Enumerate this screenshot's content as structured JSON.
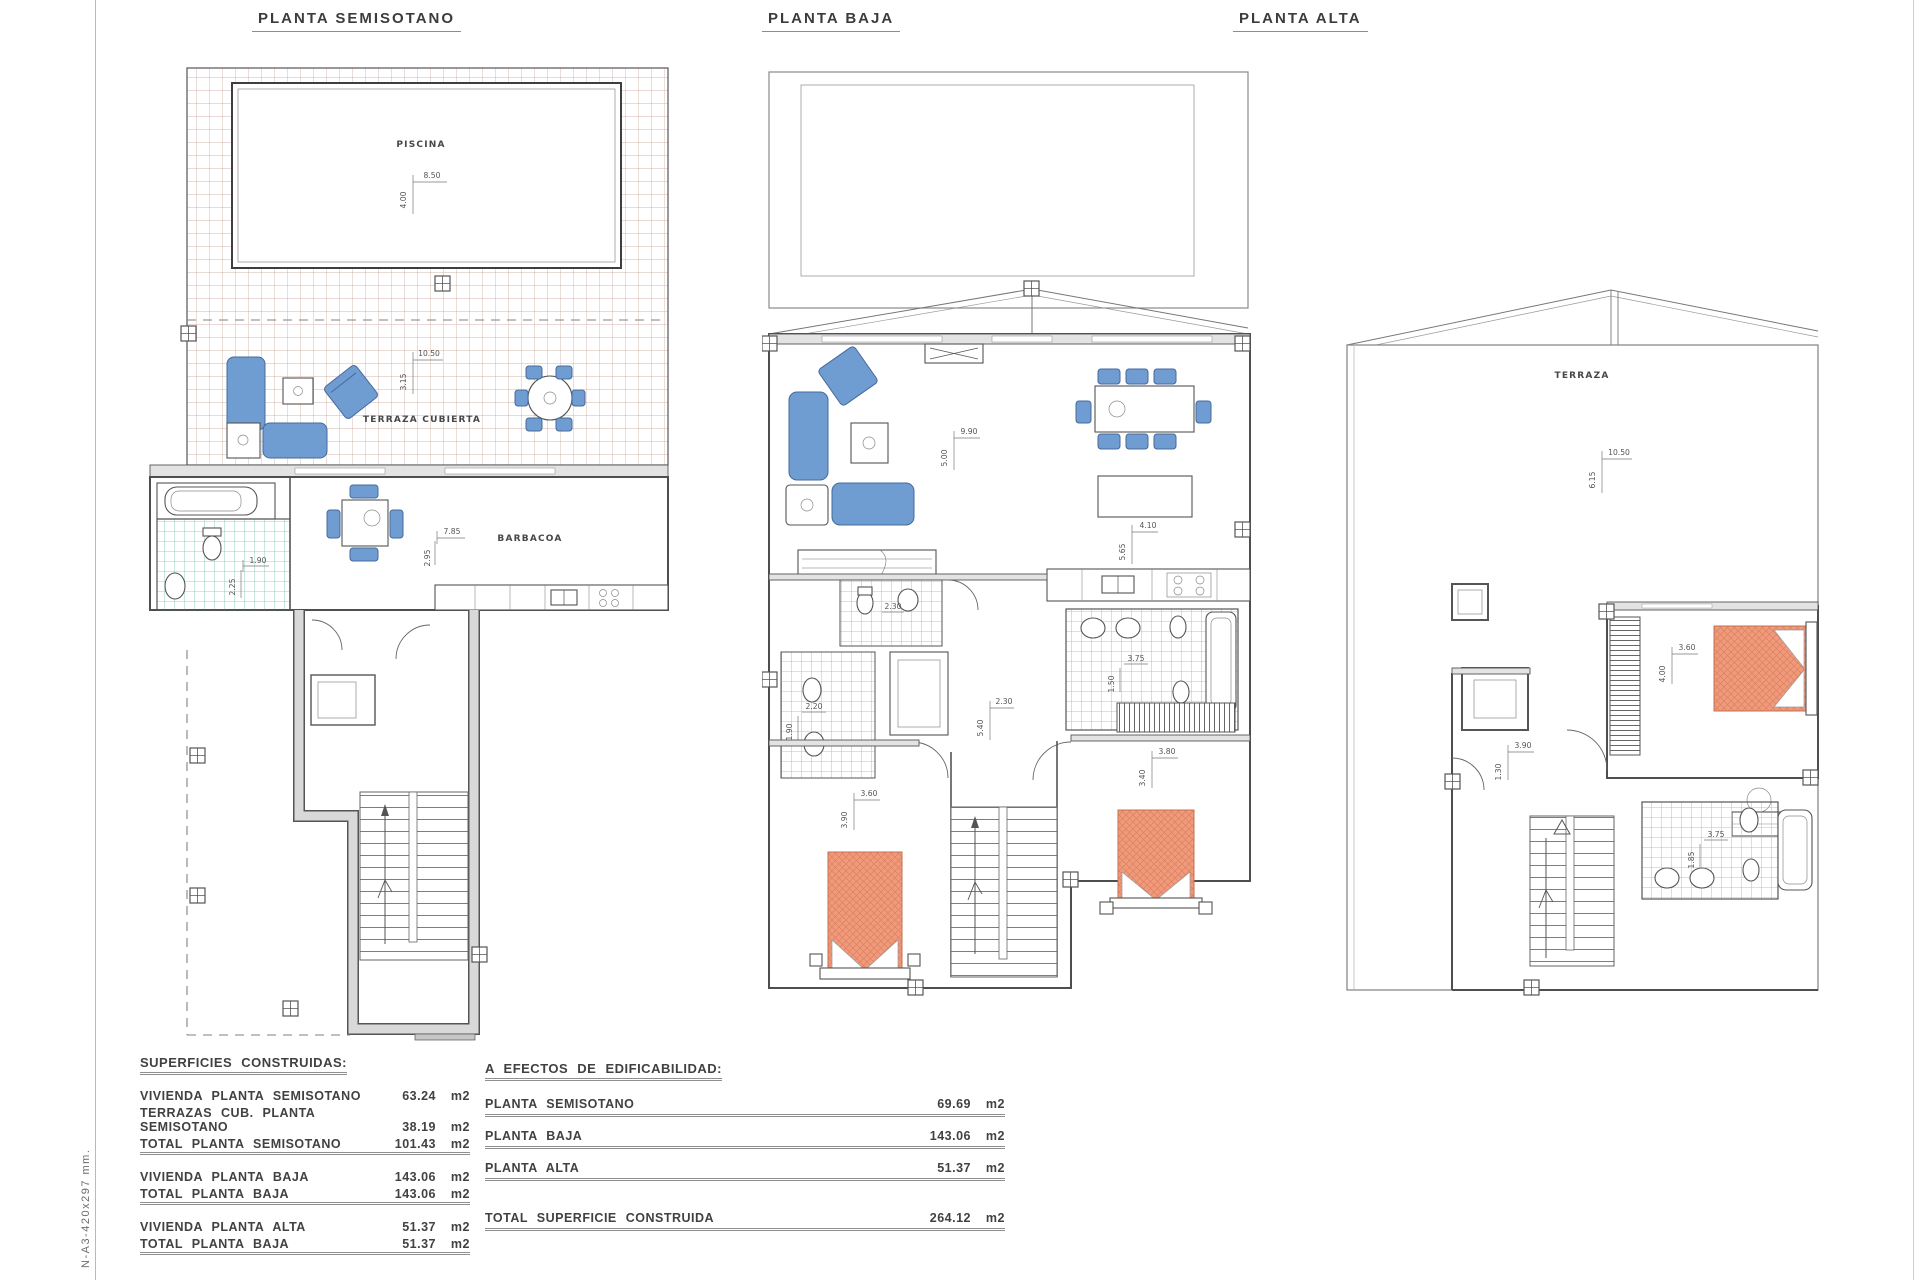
{
  "page": {
    "side_note": "N-A3-420x297  mm.",
    "paper_color": "#ffffff",
    "accent_blue": "#6f9dd1",
    "accent_orange": "#f09a7c",
    "accent_green": "#7cc3aa"
  },
  "plans": {
    "semisotano": {
      "title": "PLANTA SEMISOTANO",
      "labels": {
        "pool": "PISCINA",
        "terrace": "TERRAZA CUBIERTA",
        "barbecue": "BARBACOA"
      },
      "dims": {
        "pool_w": "8.50",
        "pool_d": "4.00",
        "terrace_w": "10.50",
        "terrace_d": "3.15",
        "bath_w": "1.90",
        "bath_d": "2.25",
        "room_w": "7.85",
        "room_d": "2.95"
      }
    },
    "baja": {
      "title": "PLANTA BAJA",
      "dims": {
        "living_w": "9.90",
        "living_d": "5.00",
        "kitchen_w": "4.10",
        "kitchen_d": "5.65",
        "bath1_w": "2.30",
        "bath2_w": "2.20",
        "bath2_d": "1.90",
        "bath3_w": "3.75",
        "bath3_d": "1.50",
        "hall_w": "2.30",
        "hall_d": "5.40",
        "bed1_w": "3.60",
        "bed1_d": "3.90",
        "bed2_w": "3.80",
        "bed2_d": "3.40"
      }
    },
    "alta": {
      "title": "PLANTA ALTA",
      "labels": {
        "terrace": "TERRAZA"
      },
      "dims": {
        "terrace_w": "10.50",
        "terrace_d": "6.15",
        "bed_w": "3.60",
        "bed_d": "4.00",
        "hall_w": "3.90",
        "hall_d": "1.30",
        "bath_w": "3.75",
        "bath_d": "1.85"
      }
    }
  },
  "tables": {
    "built": {
      "title": "SUPERFICIES CONSTRUIDAS:",
      "rows": [
        {
          "label": "VIVIENDA PLANTA SEMISOTANO",
          "value": "63.24",
          "unit": "m2"
        },
        {
          "label": "TERRAZAS CUB. PLANTA SEMISOTANO",
          "value": "38.19",
          "unit": "m2"
        },
        {
          "label": "TOTAL PLANTA SEMISOTANO",
          "value": "101.43",
          "unit": "m2"
        },
        {
          "label": "VIVIENDA PLANTA BAJA",
          "value": "143.06",
          "unit": "m2"
        },
        {
          "label": "TOTAL PLANTA BAJA",
          "value": "143.06",
          "unit": "m2"
        },
        {
          "label": "VIVIENDA PLANTA ALTA",
          "value": "51.37",
          "unit": "m2"
        },
        {
          "label": "TOTAL PLANTA BAJA",
          "value": "51.37",
          "unit": "m2"
        },
        {
          "label": "TOTAL SUPERFICIE CONSTRUIDA",
          "value": "295.86",
          "unit": "m2"
        }
      ]
    },
    "edificability": {
      "title": "A EFECTOS DE EDIFICABILIDAD:",
      "rows": [
        {
          "label": "PLANTA SEMISOTANO",
          "value": "69.69",
          "unit": "m2"
        },
        {
          "label": "PLANTA BAJA",
          "value": "143.06",
          "unit": "m2"
        },
        {
          "label": "PLANTA ALTA",
          "value": "51.37",
          "unit": "m2"
        },
        {
          "label": "TOTAL SUPERFICIE CONSTRUIDA",
          "value": "264.12",
          "unit": "m2"
        }
      ]
    }
  }
}
